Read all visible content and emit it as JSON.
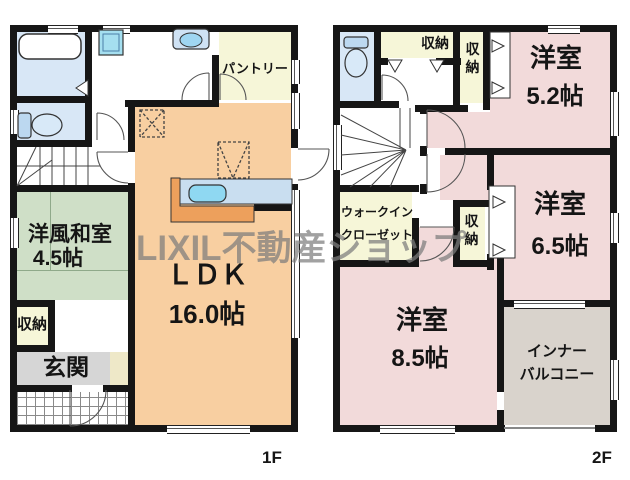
{
  "watermark": "LIXIL不動産ショップ",
  "floor_1f": {
    "label": "1F",
    "rooms": {
      "washitsu": {
        "name": "洋風和室",
        "size": "4.5帖"
      },
      "ldk": {
        "name": "ＬＤＫ",
        "size": "16.0帖"
      },
      "pantry": {
        "name": "パントリー"
      },
      "storage": {
        "name": "収納"
      },
      "genkan": {
        "name": "玄関"
      }
    }
  },
  "floor_2f": {
    "label": "2F",
    "rooms": {
      "bedroom_52": {
        "name": "洋室",
        "size": "5.2帖"
      },
      "bedroom_65": {
        "name": "洋室",
        "size": "6.5帖"
      },
      "bedroom_85": {
        "name": "洋室",
        "size": "8.5帖"
      },
      "walk_in_closet": {
        "line1": "ウォークイン",
        "line2": "クローゼット"
      },
      "storage_hall": {
        "name": "収納"
      },
      "storage_52": {
        "name": "収納"
      },
      "storage_65": {
        "name": "収納"
      },
      "inner_balcony": {
        "line1": "インナー",
        "line2": "バルコニー"
      }
    }
  }
}
